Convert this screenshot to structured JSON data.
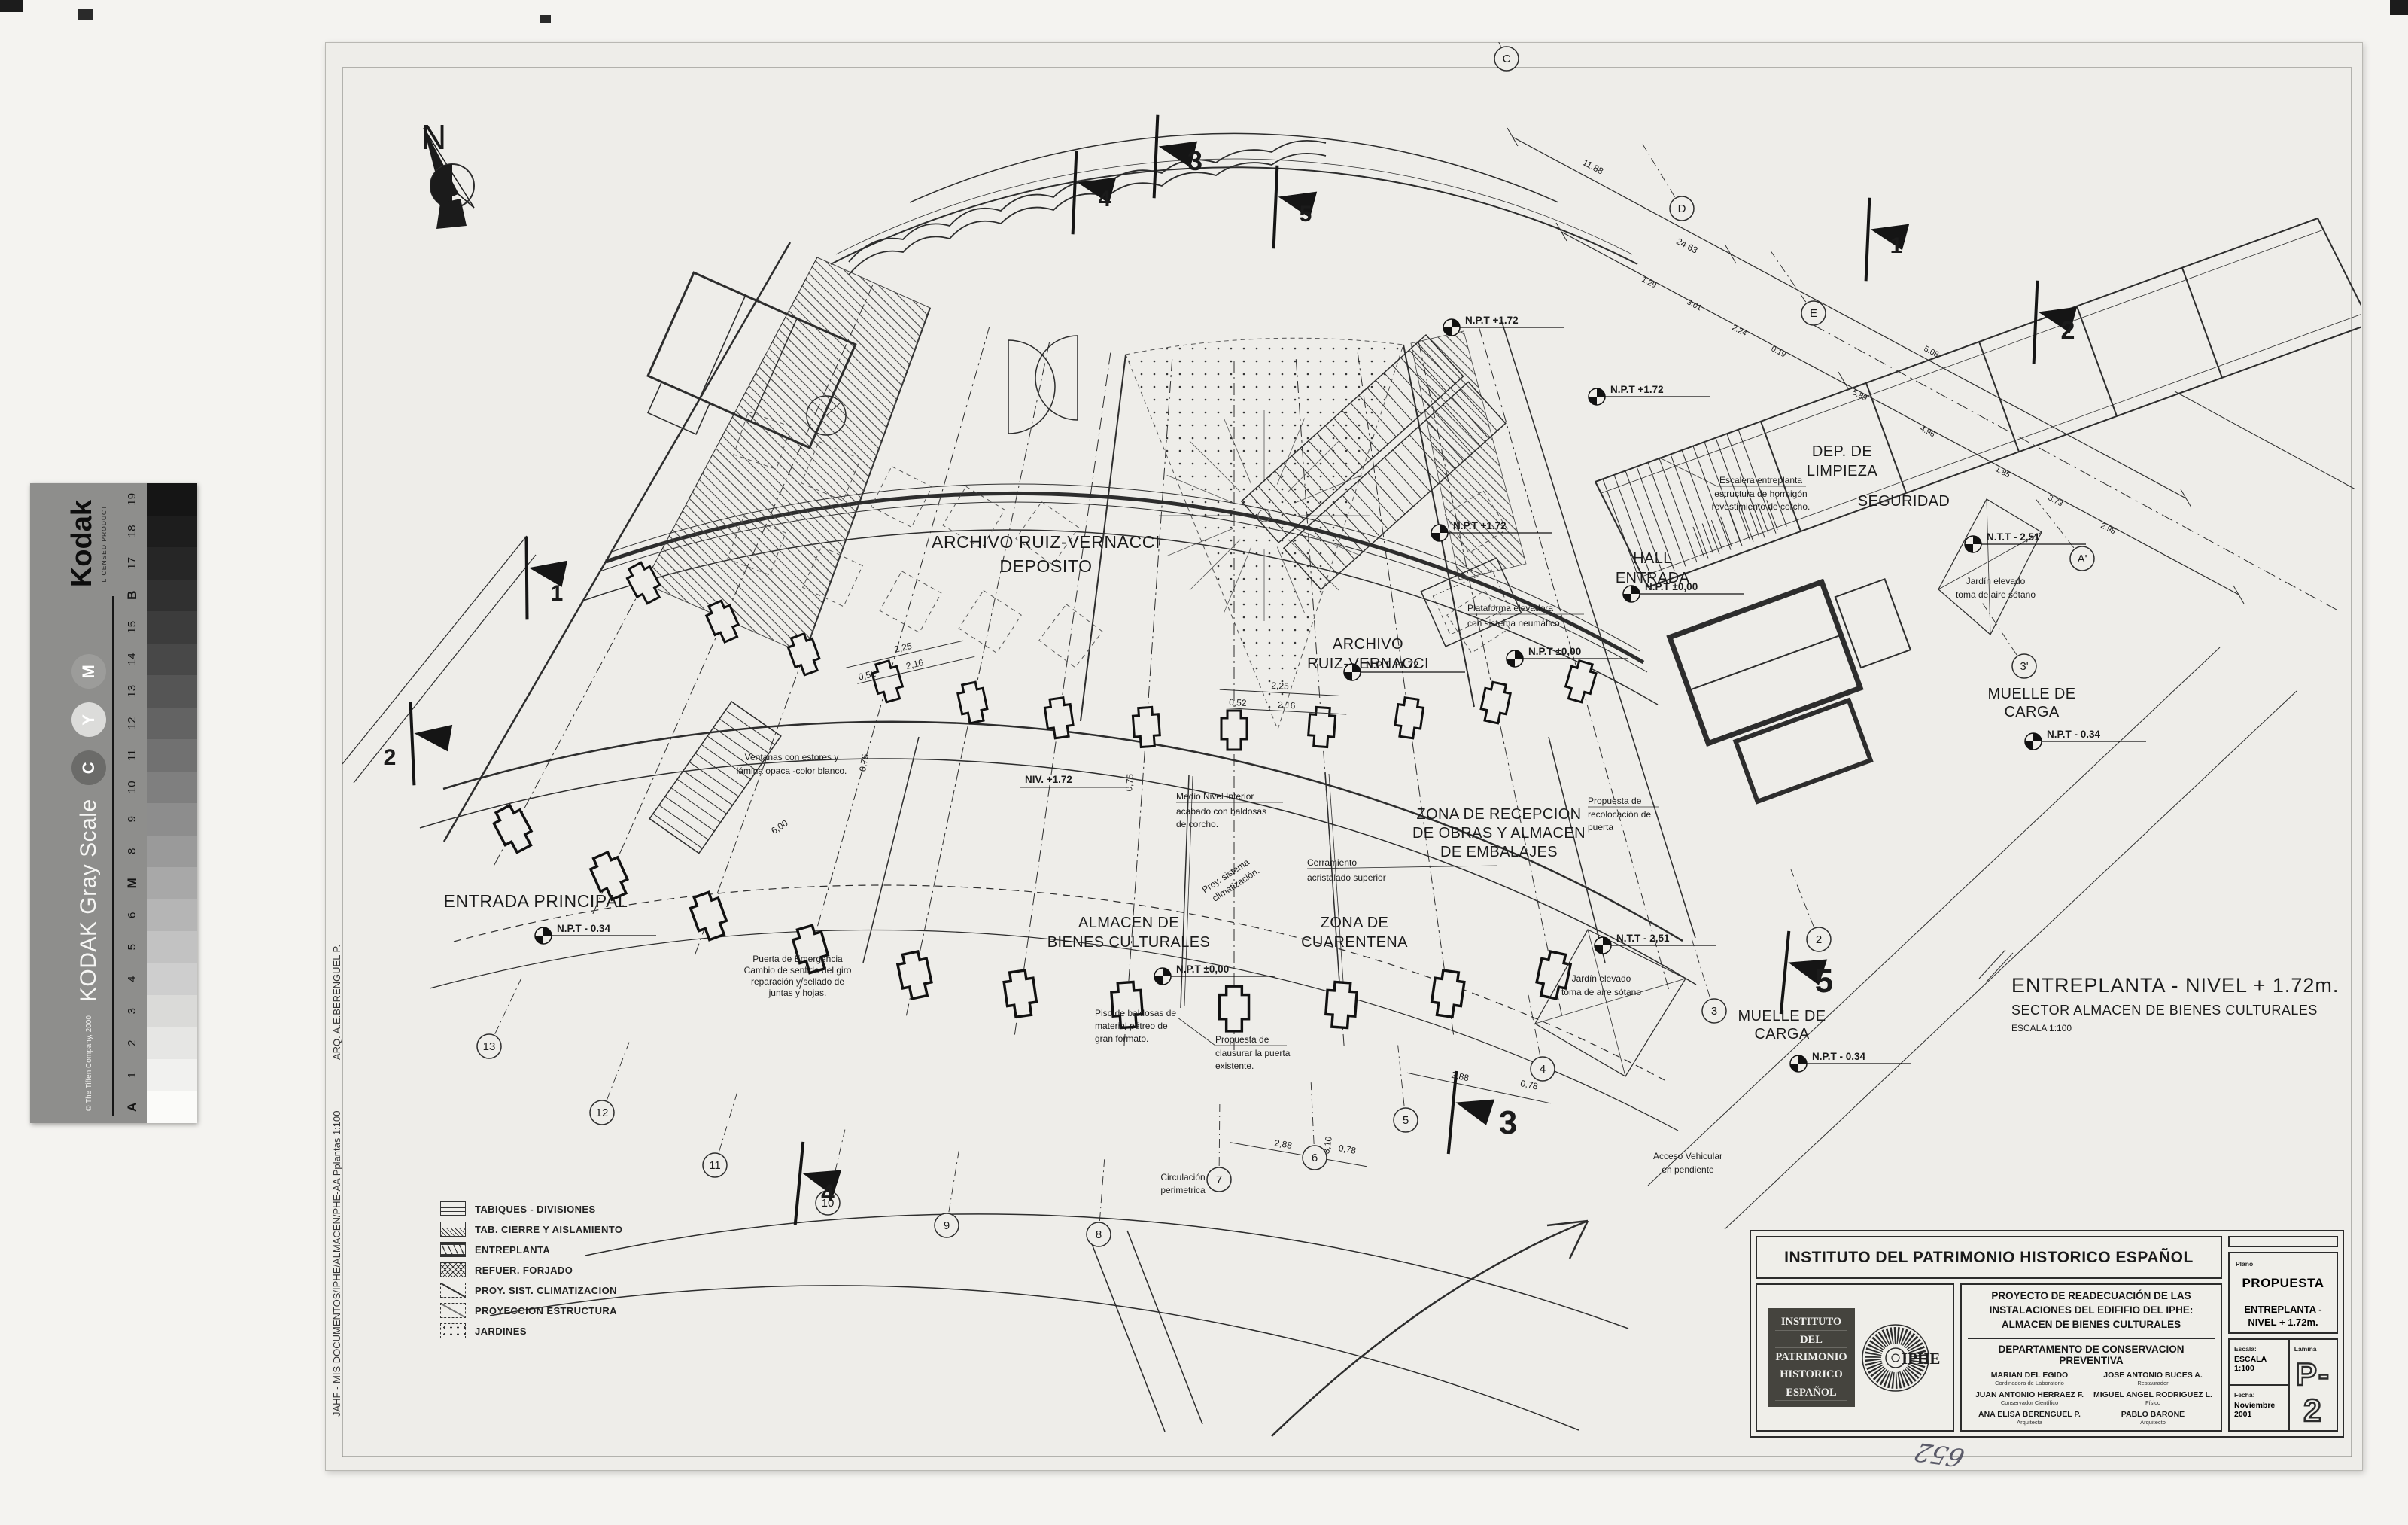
{
  "scan": {
    "handwritten_note": "652"
  },
  "kodak": {
    "brand": "Kodak",
    "licensed": "LICENSED PRODUCT",
    "product_title": "KODAK Gray Scale",
    "copyright": "© The Tiffen Company, 2000",
    "cmy": [
      "C",
      "Y",
      "M"
    ],
    "scale_labels": [
      "A",
      "1",
      "2",
      "3",
      "4",
      "5",
      "6",
      "M",
      "8",
      "9",
      "10",
      "11",
      "12",
      "13",
      "14",
      "15",
      "B",
      "17",
      "18",
      "19"
    ],
    "patch_grays": [
      "#fbfbf9",
      "#f1f1ef",
      "#e6e6e4",
      "#dadad8",
      "#cecece",
      "#c2c2c2",
      "#b5b5b5",
      "#a8a8a8",
      "#9a9a9a",
      "#8d8d8d",
      "#7f7f7f",
      "#717171",
      "#636363",
      "#555555",
      "#484848",
      "#3c3c3c",
      "#303030",
      "#262626",
      "#1d1d1d",
      "#151515"
    ]
  },
  "margin": {
    "architect": "ARQ. A.E.BERENGUEL P.",
    "file_path": "JAHF - MIS DOCUMENTOS/IPHE/ALMACEN/PHE-AA Pplantas 1:100"
  },
  "compass": {
    "label": "N"
  },
  "plan_title": {
    "line1": "ENTREPLANTA - NIVEL + 1.72m.",
    "line2": "SECTOR ALMACEN DE BIENES CULTURALES",
    "line3": "ESCALA  1:100"
  },
  "plan": {
    "rooms": {
      "archivo_deposito_1": "ARCHIVO RUIZ-VERNACCI",
      "archivo_deposito_2": "DEPOSITO",
      "archivo_1": "ARCHIVO",
      "archivo_2": "RUIZ-VERNACCI",
      "hall_1": "HALL",
      "hall_2": "ENTRADA",
      "dep_limpieza_1": "DEP. DE",
      "dep_limpieza_2": "LIMPIEZA",
      "seguridad": "SEGURIDAD",
      "muelle_1": "MUELLE DE",
      "muelle_2": "CARGA",
      "recepcion_1": "ZONA DE RECEPCION",
      "recepcion_2": "DE OBRAS Y ALMACEN",
      "recepcion_3": "DE EMBALAJES",
      "cuarentena_1": "ZONA DE",
      "cuarentena_2": "CUARENTENA",
      "almacen_1": "ALMACEN  DE",
      "almacen_2": "BIENES CULTURALES",
      "entrada_principal": "ENTRADA PRINCIPAL"
    },
    "levels": {
      "npt_172": "N.P.T +1.72",
      "npt_000": "N.P.T ±0,00",
      "npt_034": "N.P.T - 0.34",
      "ntt_251": "N.T.T - 2,51",
      "niv_172": "NIV. +1.72"
    },
    "notes": {
      "plataforma_1": "Plataforma elevadora",
      "plataforma_2": "con sistema neumático",
      "medio_nivel_1": "Medio Nivel Interior",
      "medio_nivel_2": "acabado con baldosas",
      "medio_nivel_3": "de corcho.",
      "proy_clima_1": "Proy. sistema",
      "proy_clima_2": "climatización.",
      "cerramiento_1": "Cerramiento",
      "cerramiento_2": "acristalado superior",
      "piso_1": "Piso de baldosas de",
      "piso_2": "material pétreo de",
      "piso_3": "gran formato.",
      "puerta_emergencia_1": "Puerta de Emergencia",
      "puerta_emergencia_2": "Cambio de sentido del giro",
      "puerta_emergencia_3": "reparación y sellado de",
      "puerta_emergencia_4": "juntas y hojas.",
      "clausura_1": "Propuesta de",
      "clausura_2": "clausurar la puerta",
      "clausura_3": "existente.",
      "recolocacion_1": "Propuesta de",
      "recolocacion_2": "recolocación de",
      "recolocacion_3": "puerta",
      "escalera_1": "Escalera entreplanta",
      "escalera_2": "estructura de hormigón",
      "escalera_3": "revestimiento de corcho.",
      "ventanas_1": "Ventanas con estores y",
      "ventanas_2": "lámina opaca -color blanco.",
      "jardin_1": "Jardín elevado",
      "jardin_2": "toma de aire sótano",
      "circulacion_1": "Circulación",
      "circulacion_2": "perimetrica",
      "acceso_1": "Acceso Vehicular",
      "acceso_2": "en pendiente"
    },
    "dims": {
      "d225": "2,25",
      "d216": "2,16",
      "d052": "0,52",
      "d288": "2,88",
      "d078": "0,78",
      "d310": "3,10",
      "d075": "0,75",
      "d600": "6,00",
      "d1188": "11.88",
      "d2463": "24.63",
      "d129": "1.29",
      "d301": "3.01",
      "d224": "2.24",
      "d019": "0.19",
      "d589": "5.89",
      "d496": "4.96",
      "d185": "1.85",
      "d373": "3.73",
      "d295": "2.95",
      "d508": "5.08"
    },
    "bubbles": {
      "c": "C",
      "d": "D",
      "e": "E",
      "a1": "A'",
      "p3": "3'",
      "n2": "2",
      "n3": "3",
      "n4": "4",
      "n5": "5",
      "n6": "6",
      "n7": "7",
      "n8": "8",
      "n9": "9",
      "n10": "10",
      "n11": "11",
      "n12": "12",
      "n13": "13"
    },
    "flags": {
      "f1": "1",
      "f2": "2",
      "f3": "3",
      "f4": "4",
      "f5": "5"
    }
  },
  "legend": {
    "items": [
      {
        "label": "TABIQUES - DIVISIONES",
        "pattern": "tabiques"
      },
      {
        "label": "TAB. CIERRE Y AISLAMIENTO",
        "pattern": "cierre"
      },
      {
        "label": "ENTREPLANTA",
        "pattern": "entreplanta"
      },
      {
        "label": "REFUER. FORJADO",
        "pattern": "forjado"
      },
      {
        "label": "PROY. SIST. CLIMATIZACION",
        "pattern": "clima"
      },
      {
        "label": "PROYECCION ESTRUCTURA",
        "pattern": "estructura"
      },
      {
        "label": "JARDINES",
        "pattern": "jardines"
      }
    ]
  },
  "title_block": {
    "institution": "INSTITUTO DEL PATRIMONIO HISTORICO ESPAÑOL",
    "logo_lines": [
      "INSTITUTO",
      "DEL",
      "PATRIMONIO",
      "HISTORICO",
      "ESPAÑOL"
    ],
    "logo_acronym": "IPHE",
    "project_1": "PROYECTO DE READECUACIÓN DE LAS",
    "project_2": "INSTALACIONES DEL EDIFIFIO DEL IPHE:",
    "project_3": "ALMACEN DE BIENES CULTURALES",
    "department": "DEPARTAMENTO DE CONSERVACION PREVENTIVA",
    "team": [
      {
        "name": "MARIAN DEL EGIDO",
        "role": "Cordinadora de Laboratorio"
      },
      {
        "name": "JOSE ANTONIO BUCES A.",
        "role": "Restaurador"
      },
      {
        "name": "JUAN ANTONIO HERRAEZ F.",
        "role": "Conservador Científico"
      },
      {
        "name": "MIGUEL ANGEL RODRIGUEZ L.",
        "role": "Físico"
      },
      {
        "name": "ANA ELISA BERENGUEL P.",
        "role": "Arquitecta"
      },
      {
        "name": "PABLO BARONE",
        "role": "Arquitecto"
      }
    ],
    "plano_label": "Plano",
    "plano_value": "PROPUESTA",
    "plano_subtitle": "ENTREPLANTA - NIVEL + 1.72m.",
    "escala_label": "Escala:",
    "escala_value": "ESCALA  1:100",
    "fecha_label": "Fecha:",
    "fecha_value": "Noviembre 2001",
    "lamina_label": "Lamina",
    "lamina_value": "P-2"
  }
}
